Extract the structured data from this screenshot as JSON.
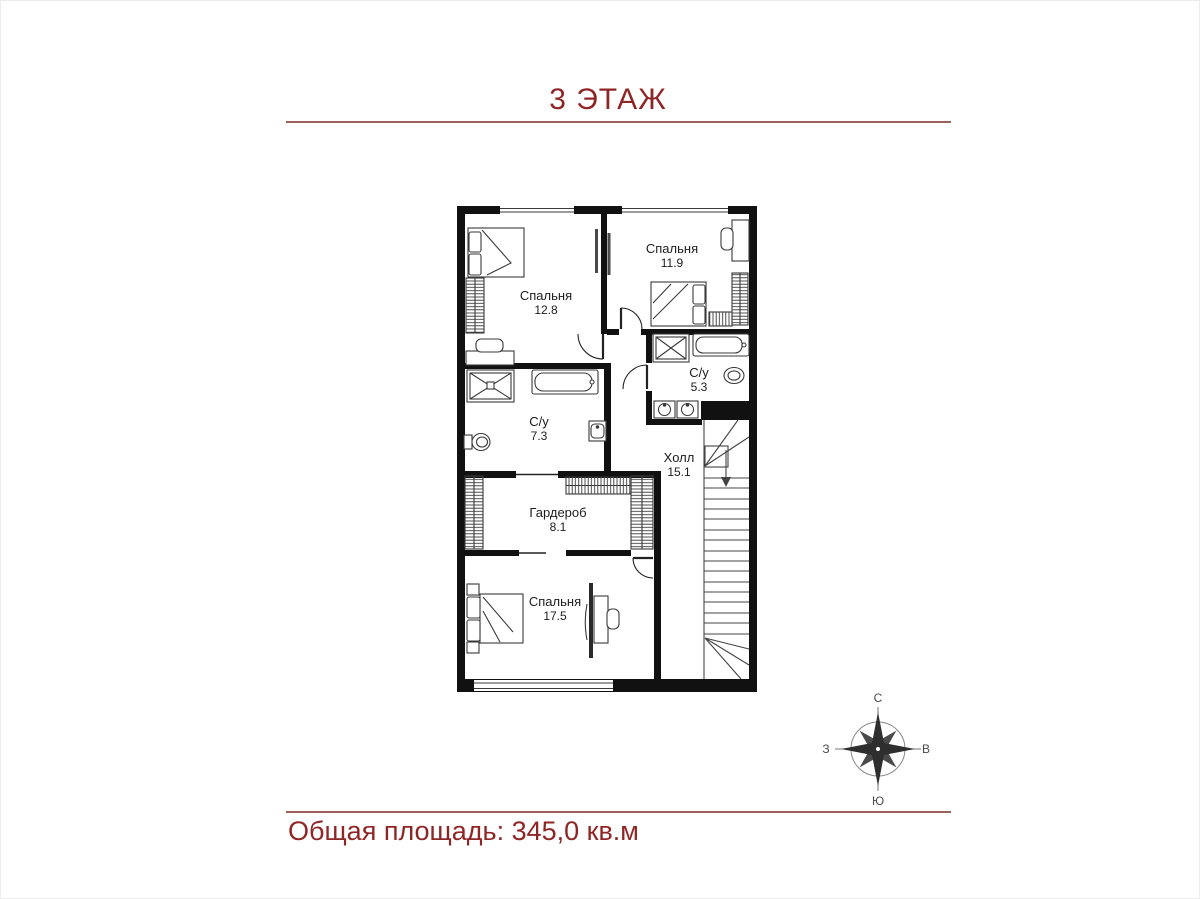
{
  "title": "3 ЭТАЖ",
  "total_area": "Общая площадь: 345,0 кв.м",
  "rooms": [
    {
      "name": "Спальня",
      "area": "12.8"
    },
    {
      "name": "Спальня",
      "area": "11.9"
    },
    {
      "name": "С/у",
      "area": "5.3"
    },
    {
      "name": "С/у",
      "area": "7.3"
    },
    {
      "name": "Холл",
      "area": "15.1"
    },
    {
      "name": "Гардероб",
      "area": "8.1"
    },
    {
      "name": "Спальня",
      "area": "17.5"
    }
  ],
  "compass": {
    "north": "С",
    "east": "В",
    "south": "Ю",
    "west": "З"
  },
  "colors": {
    "accent_text": "#8f2626",
    "divider_line": "#9c615b",
    "walls": "#111111"
  }
}
